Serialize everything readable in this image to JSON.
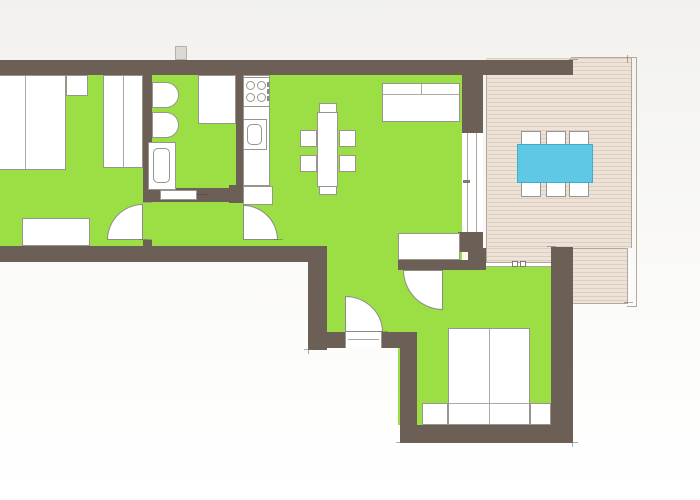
{
  "title": "apartment-floor-plan",
  "colors": {
    "wall": "#6b5f56",
    "floor_green": "#9cdf45",
    "deck_wood": "#ece2d8",
    "deck_edge_line": "#b3a89c",
    "furniture_outline": "#97968c",
    "door_arc_line": "#8d8c84",
    "outdoor_table_blue": "#5ec8e5",
    "outdoor_table_blue_border": "#3fadcc",
    "background_top": "#f2f1ee",
    "background_bottom": "#fdfdfc"
  },
  "rooms": [
    {
      "id": "bedroom-1",
      "position": "west",
      "furniture": [
        "double-bed",
        "nightstand",
        "wardrobe",
        "dresser"
      ],
      "door": "hinged-to-hallway"
    },
    {
      "id": "bathroom",
      "position": "center-west",
      "furniture": [
        "toilet",
        "bidet",
        "shower",
        "washbasin"
      ],
      "door": "sliding"
    },
    {
      "id": "hallway",
      "position": "center",
      "doors": [
        "bedroom-1-door",
        "entry-door"
      ]
    },
    {
      "id": "kitchen-living-room",
      "position": "center-east",
      "furniture": [
        "kitchen-counter",
        "stove",
        "sink",
        "fridge",
        "dining-table",
        "dining-chairs",
        "sofa",
        "sideboard"
      ],
      "glass_door": "to-deck"
    },
    {
      "id": "bedroom-2",
      "position": "south-east",
      "furniture": [
        "double-bed",
        "nightstand-left",
        "nightstand-right"
      ],
      "window": "to-deck",
      "door": "hinged"
    },
    {
      "id": "deck",
      "position": "east",
      "floor": "wood-planks",
      "furniture": [
        "outdoor-table",
        "outdoor-chairs"
      ]
    }
  ],
  "counts": {
    "stove_burners": 4,
    "dining_chairs": 6,
    "deck_chairs": 6,
    "door_swing_arcs": 4,
    "rooms_green_floored": 5
  }
}
